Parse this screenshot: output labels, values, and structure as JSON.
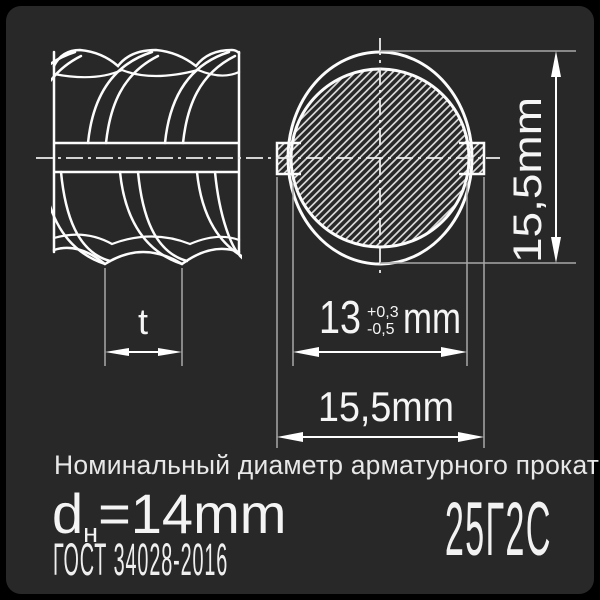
{
  "colors": {
    "background": "#000000",
    "card": "#282828",
    "line": "#fcfcfc",
    "extension_line": "#a8a8a8",
    "text": "#f0f0f0"
  },
  "dimensions": {
    "height_label": "15,5mm",
    "core_value": "13",
    "core_tol_plus": "+0,3",
    "core_tol_minus": "-0,5",
    "core_unit": "mm",
    "width_label": "15,5mm",
    "rib_pitch_label": "t"
  },
  "caption": {
    "title": "Номинальный диаметр арматурного проката",
    "diameter_symbol": "d",
    "diameter_subscript": "н",
    "diameter_value": "=14mm",
    "standard": "ГОСТ 34028-2016",
    "steel_grade": "25Г2С"
  }
}
